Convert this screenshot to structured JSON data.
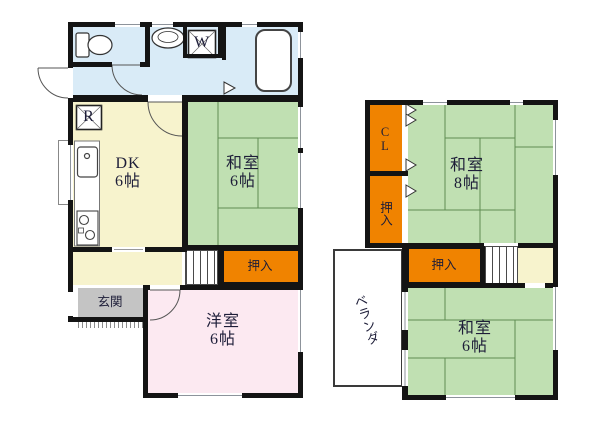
{
  "floor1": {
    "rooms": {
      "dk": {
        "name": "DK",
        "size": "6帖"
      },
      "washitsu": {
        "name": "和室",
        "size": "6帖"
      },
      "yoshitsu": {
        "name": "洋室",
        "size": "6帖"
      },
      "oshiire": {
        "name": "押入"
      },
      "genkan": {
        "name": "玄関"
      }
    },
    "appliances": {
      "refrigerator": "R",
      "washer": "W"
    }
  },
  "floor2": {
    "rooms": {
      "washitsu8": {
        "name": "和室",
        "size": "8帖"
      },
      "washitsu6": {
        "name": "和室",
        "size": "6帖"
      },
      "closet": {
        "name": "CL"
      },
      "oshiire_upper": {
        "name": "押入"
      },
      "oshiire_lower": {
        "name": "押入"
      },
      "veranda": {
        "name": "ベランダ"
      }
    }
  },
  "colors": {
    "wall": "#141414",
    "water_blue": "#d9ebf7",
    "dk_yellow": "#f7f3cd",
    "tatami_green": "#c0e0b2",
    "closet_orange": "#f08300",
    "western_pink": "#fce9f1",
    "entrance_gray": "#c4c4c4",
    "tatami_line": "#5f8d52"
  }
}
